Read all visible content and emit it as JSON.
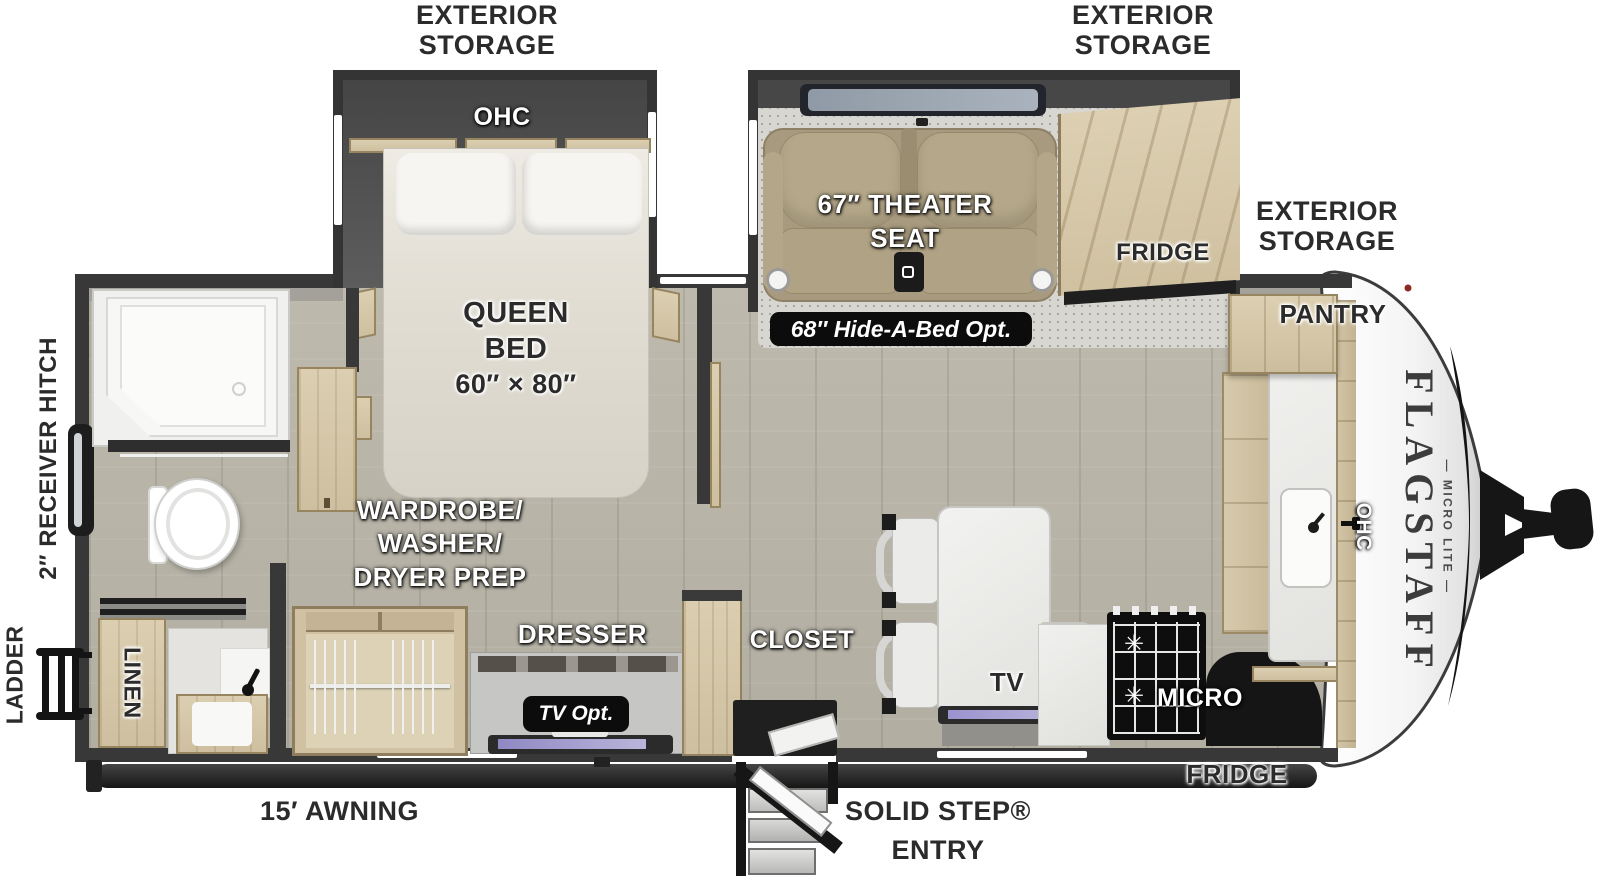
{
  "colors": {
    "wall": "#383838",
    "floor": "#b7b3a7",
    "carpet": "#d8d6d0",
    "wood_cabinet": "#d5c8aa",
    "theater_seat_tan": "#a89a7e",
    "counter_white": "#eeeeec",
    "tv_screen_purple": "#938bc7",
    "label_dark": "#2b2b2b",
    "label_pill_bg": "#0c0c0c",
    "front_cap_white": "#f7f7f7",
    "accent_swoosh": "#141414"
  },
  "labels": {
    "exterior_storage_bedroom": {
      "line1": "EXTERIOR",
      "line2": "STORAGE"
    },
    "exterior_storage_living": {
      "line1": "EXTERIOR",
      "line2": "STORAGE"
    },
    "exterior_storage_front": {
      "line1": "EXTERIOR",
      "line2": "STORAGE"
    },
    "receiver_hitch": "2″ RECEIVER HITCH",
    "ladder": "LADDER",
    "awning": "15′ AWNING",
    "solid_step": {
      "line1": "SOLID STEP®",
      "line2": "ENTRY"
    },
    "fridge_exterior": "FRIDGE"
  },
  "bedroom": {
    "ohc": "OHC",
    "queen_line1": "QUEEN",
    "queen_line2": "BED",
    "queen_line3": "60″ × 80″"
  },
  "living": {
    "theater_line1": "67″ THEATER",
    "theater_line2": "SEAT",
    "hide_a_bed": "68″ Hide-A-Bed Opt.",
    "fridge": "FRIDGE",
    "tv": "TV"
  },
  "kitchen": {
    "pantry": "PANTRY",
    "ohc": "OHC",
    "micro": "MICRO"
  },
  "bathroom": {
    "linen": "LINEN"
  },
  "dressing": {
    "wardrobe_line1": "WARDROBE/",
    "wardrobe_line2": "WASHER/",
    "wardrobe_line3": "DRYER PREP",
    "dresser": "DRESSER",
    "tv_opt": "TV Opt.",
    "closet": "CLOSET"
  },
  "brand": {
    "name": "FLAGSTAFF",
    "sub": "— MICRO LITE —"
  }
}
